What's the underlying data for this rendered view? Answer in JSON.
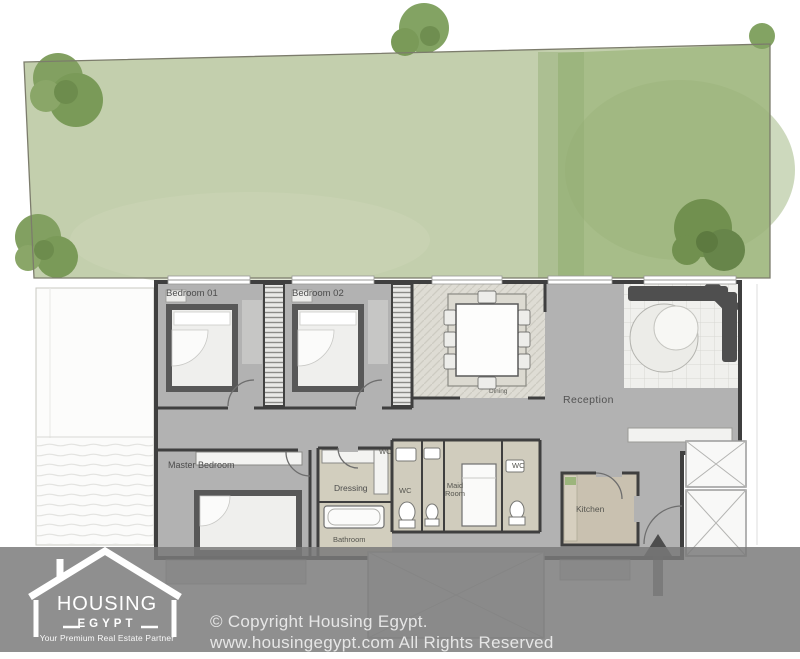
{
  "rooms": {
    "bedroom_01": "Bedroom 01",
    "bedroom_02": "Bedroom 02",
    "dining": "Dining",
    "reception": "Reception",
    "master_bedroom": "Master Bedroom",
    "dressing": "Dressing",
    "bathroom": "Bathroom",
    "wc_1": "WC",
    "wc_2": "WC",
    "wc_3": "WC",
    "maid_room": "Maid Room",
    "kitchen": "Kitchen"
  },
  "branding": {
    "name": "HOUSING",
    "subname": "EGYPT",
    "tagline": "Your Premium Real Estate Partner"
  },
  "footer": {
    "copyright_line1": "© Copyright Housing Egypt.",
    "copyright_line2": "www.housingegypt.com All Rights Reserved"
  },
  "colors": {
    "garden_light": "#c3cfad",
    "garden_dark": "#a7bd89",
    "tree_green": "#7a9a57",
    "wall_dark": "#3f3f3f",
    "floor_gray": "#b2b2b2",
    "service_floor_beige": "#d0ccbd",
    "kitchen_floor_beige": "#c9c1b0",
    "watermark_gray": "#7a7a7a",
    "logo_white": "#ffffff"
  }
}
